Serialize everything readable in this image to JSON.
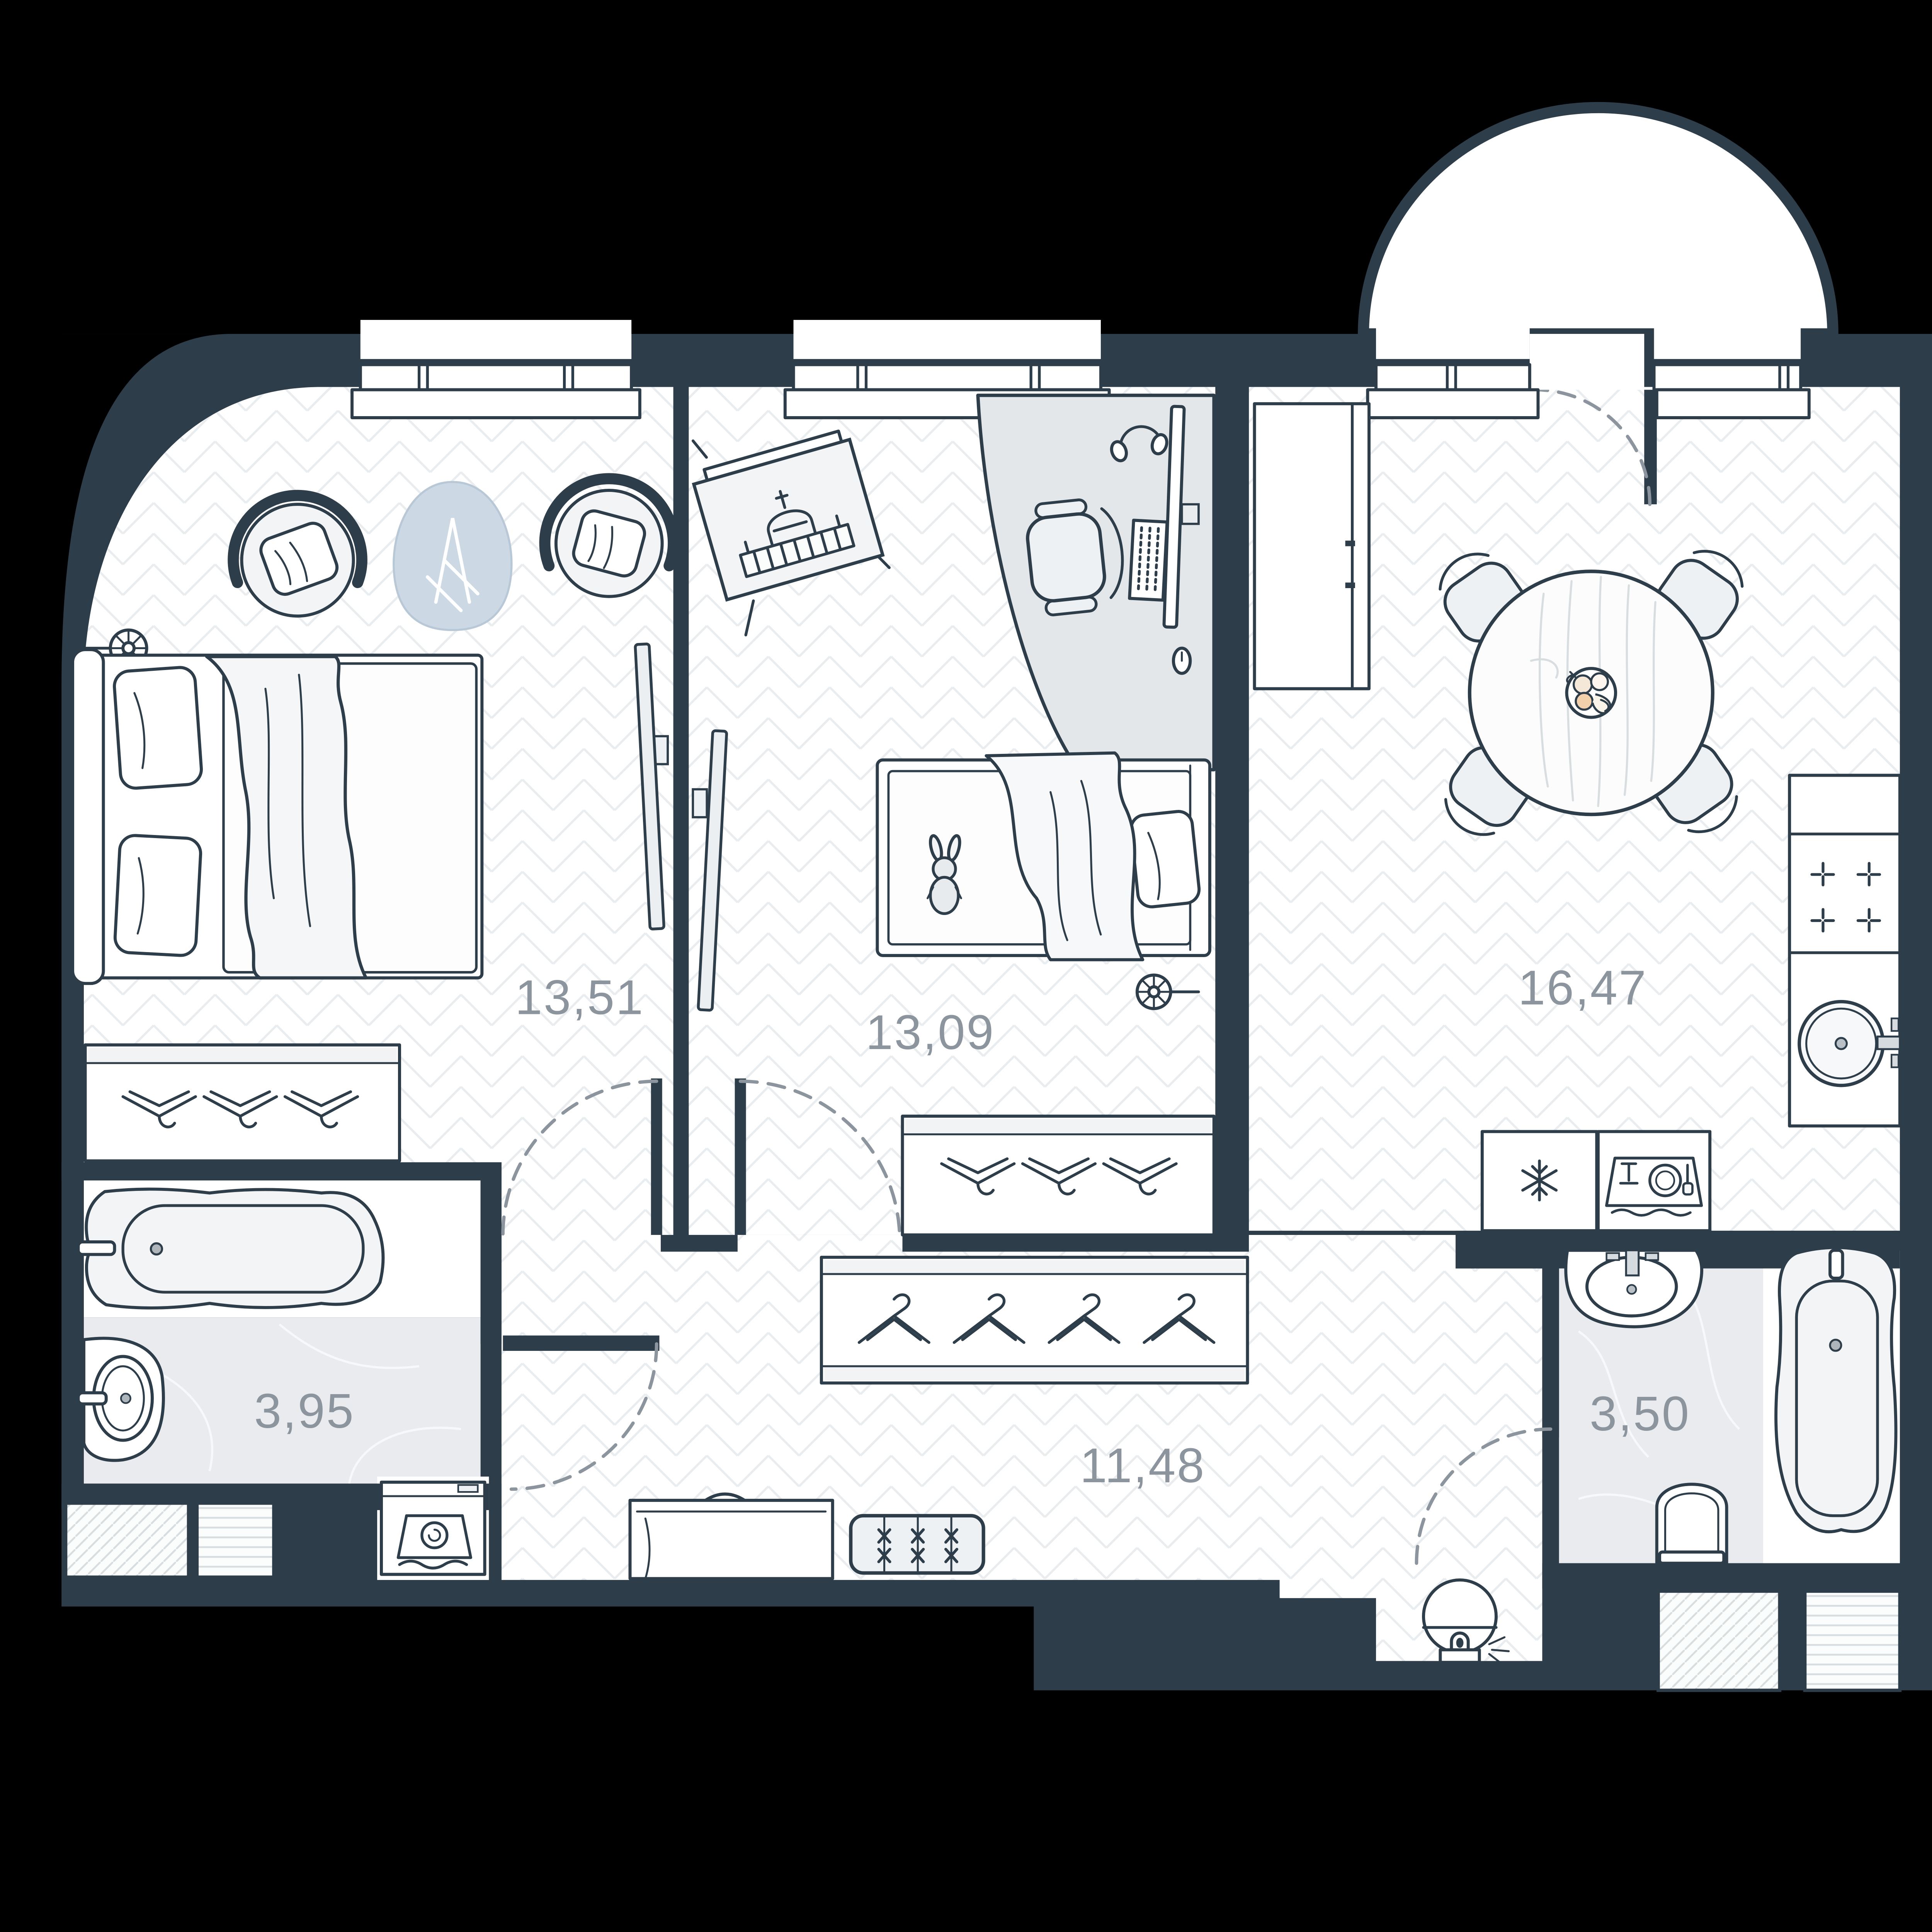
{
  "plan": {
    "type": "apartment-floor-plan",
    "area_units": "m2",
    "colors": {
      "wall": "#2e3d4a",
      "floor": "#ffffff",
      "bath": "#e9ebee",
      "furn": "#f2f4f6",
      "label": "#8c959d",
      "bg": "#000000",
      "rug": "#ccd9e4",
      "desk": "#e3e7ea",
      "grain": "#d8dde0",
      "pat": "#e9edef",
      "hatch": "#d8dde0"
    },
    "rooms": [
      {
        "name": "bedroom",
        "area": "13,51",
        "furniture": [
          "double-bed",
          "armchair",
          "armchair",
          "rug",
          "wall-flower-lamp",
          "tv",
          "wardrobe-top-hangers"
        ]
      },
      {
        "name": "children-room",
        "area": "13,09",
        "furniture": [
          "picture-easel",
          "desk",
          "desk-chair",
          "monitor",
          "keyboard",
          "headphones",
          "single-bed",
          "toy-bunny",
          "tv",
          "wardrobe-top-hangers",
          "wall-flower-lamp"
        ]
      },
      {
        "name": "kitchen-living-room",
        "area": "16,47",
        "furniture": [
          "tall-cabinet",
          "dining-table",
          "fruit-bowl",
          "chair",
          "chair",
          "chair",
          "chair",
          "counter",
          "cooktop",
          "kitchen-sink",
          "fridge",
          "dishwasher"
        ]
      },
      {
        "name": "bathroom",
        "area": "3,95",
        "furniture": [
          "bathtub",
          "sink",
          "washing-machine",
          "vent-shaft",
          "vent-shaft"
        ]
      },
      {
        "name": "hallway",
        "area": "11,48",
        "furniture": [
          "closet-hangers",
          "shoe-cabinet",
          "bench",
          "robot-vacuum"
        ]
      },
      {
        "name": "toilet-bathroom",
        "area": "3,50",
        "furniture": [
          "sink",
          "toilet",
          "bathtub",
          "vent-shaft",
          "vent-shaft"
        ]
      }
    ],
    "features": [
      "curved-corner-wall",
      "balcony-semicircle",
      "window",
      "window",
      "window-balcony-door",
      "door-swing-arcs",
      "herringbone-floor",
      "marble-floor"
    ]
  }
}
